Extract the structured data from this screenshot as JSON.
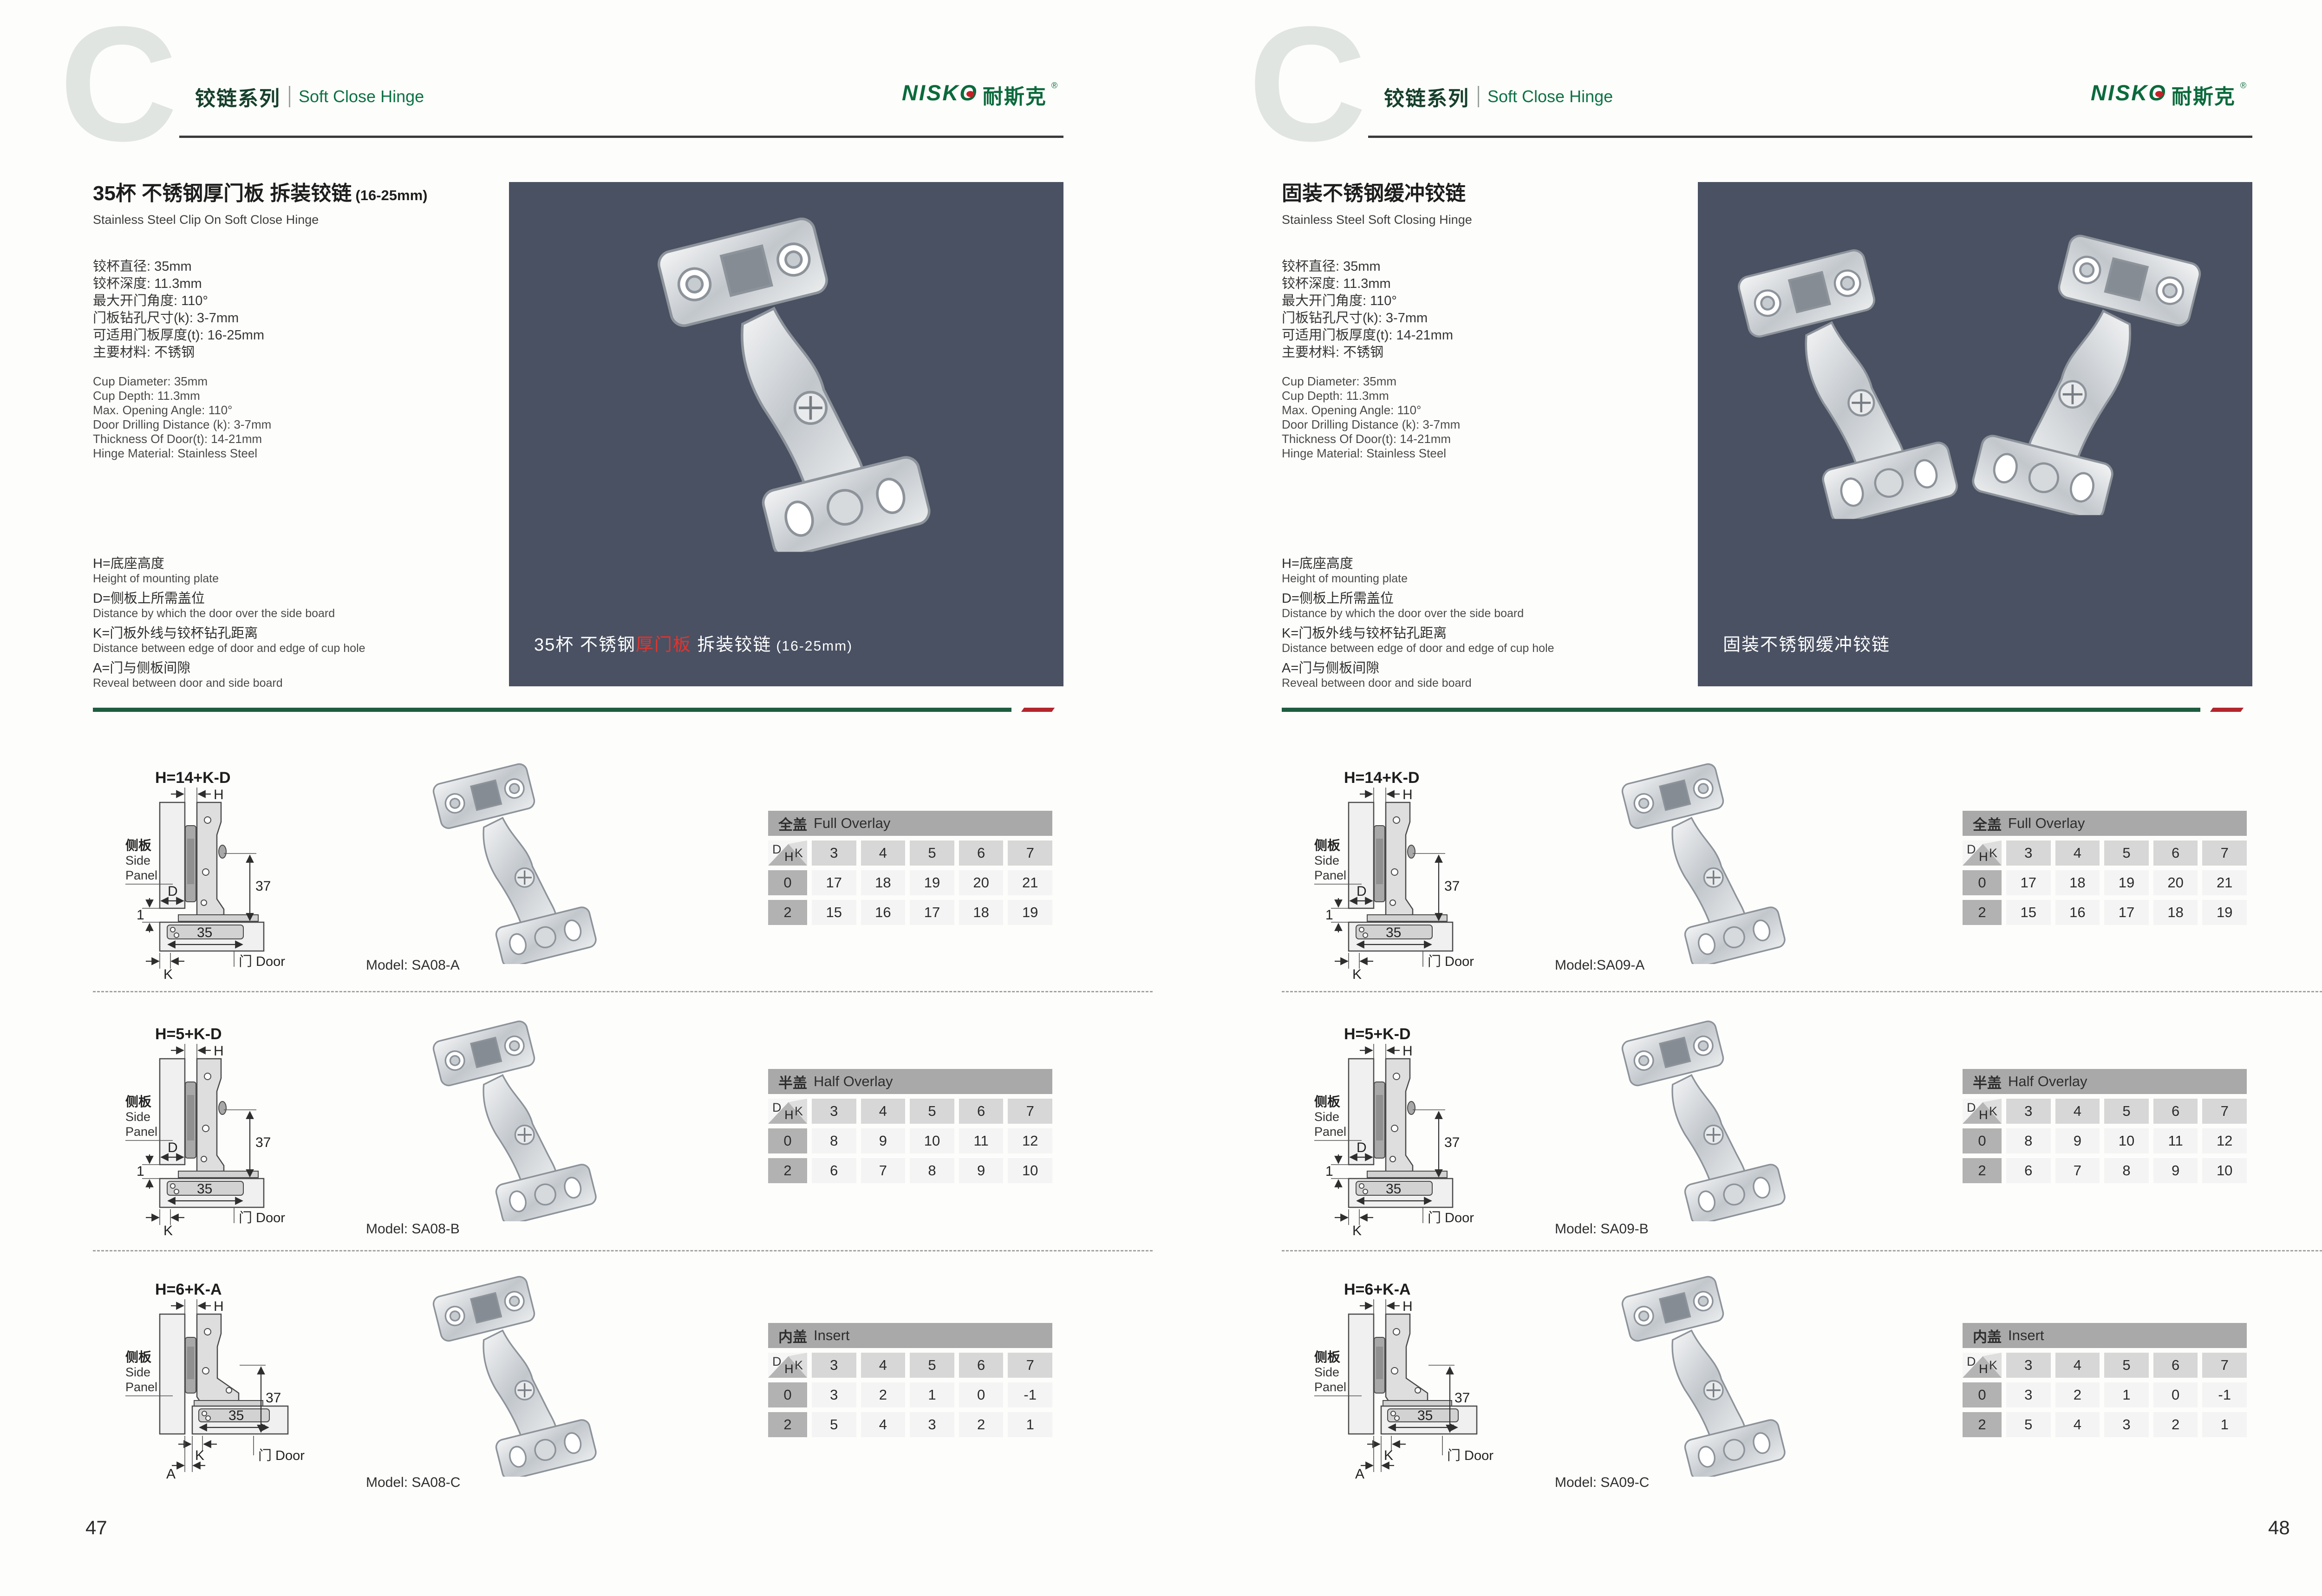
{
  "brand": {
    "logo_en": "NISKO",
    "logo_cn": "耐斯克",
    "reg": "®"
  },
  "header": {
    "watermark": "C",
    "series_cn": "铰链系列",
    "series_en": "Soft Close Hinge"
  },
  "diagram": {
    "h": "H",
    "d": "D",
    "k": "K",
    "a": "A",
    "dim37": "37",
    "dim35": "35",
    "dim1": "1",
    "side_cn": "侧板",
    "side_en1": "Side",
    "side_en2": "Panel",
    "door": "门 Door"
  },
  "tables": {
    "corner": {
      "top": "D",
      "right": "K",
      "bottom": "H"
    },
    "full": {
      "title_cn": "全盖",
      "title_en": "Full Overlay",
      "cols": [
        "3",
        "4",
        "5",
        "6",
        "7"
      ],
      "rows": [
        {
          "h": "0",
          "vals": [
            "17",
            "18",
            "19",
            "20",
            "21"
          ]
        },
        {
          "h": "2",
          "vals": [
            "15",
            "16",
            "17",
            "18",
            "19"
          ]
        }
      ]
    },
    "half": {
      "title_cn": "半盖",
      "title_en": "Half Overlay",
      "cols": [
        "3",
        "4",
        "5",
        "6",
        "7"
      ],
      "rows": [
        {
          "h": "0",
          "vals": [
            "8",
            "9",
            "10",
            "11",
            "12"
          ]
        },
        {
          "h": "2",
          "vals": [
            "6",
            "7",
            "8",
            "9",
            "10"
          ]
        }
      ]
    },
    "insert": {
      "title_cn": "内盖",
      "title_en": "Insert",
      "cols": [
        "3",
        "4",
        "5",
        "6",
        "7"
      ],
      "rows": [
        {
          "h": "0",
          "vals": [
            "3",
            "2",
            "1",
            "0",
            "-1"
          ]
        },
        {
          "h": "2",
          "vals": [
            "5",
            "4",
            "3",
            "2",
            "1"
          ]
        }
      ]
    }
  },
  "pages": [
    {
      "number": "47",
      "title_cn": "35杯 不锈钢厚门板 拆装铰链",
      "title_size": "(16-25mm)",
      "title_en": "Stainless Steel Clip On Soft Close Hinge",
      "specs_cn": [
        "铰杯直径: 35mm",
        "铰杯深度: 11.3mm",
        "最大开门角度: 110°",
        "门板钻孔尺寸(k): 3-7mm",
        "可适用门板厚度(t): 16-25mm",
        "主要材料: 不锈钢"
      ],
      "specs_en": [
        "Cup Diameter: 35mm",
        "Cup Depth: 11.3mm",
        "Max. Opening Angle: 110°",
        "Door Drilling Distance (k): 3-7mm",
        "Thickness Of Door(t): 14-21mm",
        "Hinge Material: Stainless Steel"
      ],
      "legend": [
        {
          "cn": "H=底座高度",
          "en": "Height of mounting plate"
        },
        {
          "cn": "D=侧板上所需盖位",
          "en": "Distance by which the door over the side board"
        },
        {
          "cn": "K=门板外线与铰杯钻孔距离",
          "en": "Distance between edge of door and edge of cup hole"
        },
        {
          "cn": "A=门与侧板间隙",
          "en": "Reveal between door and side board"
        }
      ],
      "photo_caption": {
        "pre": "35杯 不锈钢",
        "red": "厚门板",
        "post": " 拆装铰链",
        "size": "(16-25mm)"
      },
      "rows": [
        {
          "formula": "H=14+K-D",
          "model": "Model: SA08-A"
        },
        {
          "formula": "H=5+K-D",
          "model": "Model: SA08-B"
        },
        {
          "formula": "H=6+K-A",
          "model": "Model: SA08-C"
        }
      ]
    },
    {
      "number": "48",
      "title_cn": "固装不锈钢缓冲铰链",
      "title_size": "",
      "title_en": "Stainless Steel Soft Closing Hinge",
      "specs_cn": [
        "铰杯直径: 35mm",
        "铰杯深度: 11.3mm",
        "最大开门角度: 110°",
        "门板钻孔尺寸(k): 3-7mm",
        "可适用门板厚度(t): 14-21mm",
        "主要材料: 不锈钢"
      ],
      "specs_en": [
        "Cup Diameter: 35mm",
        "Cup Depth: 11.3mm",
        "Max. Opening Angle: 110°",
        "Door Drilling Distance (k): 3-7mm",
        "Thickness Of Door(t): 14-21mm",
        "Hinge Material: Stainless Steel"
      ],
      "legend": [
        {
          "cn": "H=底座高度",
          "en": "Height of mounting plate"
        },
        {
          "cn": "D=侧板上所需盖位",
          "en": "Distance by which the door over the side board"
        },
        {
          "cn": "K=门板外线与铰杯钻孔距离",
          "en": "Distance between edge of door and edge of cup hole"
        },
        {
          "cn": "A=门与侧板间隙",
          "en": "Reveal between door and side board"
        }
      ],
      "photo_caption": {
        "pre": "固装不锈钢缓冲铰链",
        "red": "",
        "post": "",
        "size": ""
      },
      "rows": [
        {
          "formula": "H=14+K-D",
          "model": "Model:SA09-A"
        },
        {
          "formula": "H=5+K-D",
          "model": "Model: SA09-B"
        },
        {
          "formula": "H=6+K-A",
          "model": "Model: SA09-C"
        }
      ]
    }
  ]
}
